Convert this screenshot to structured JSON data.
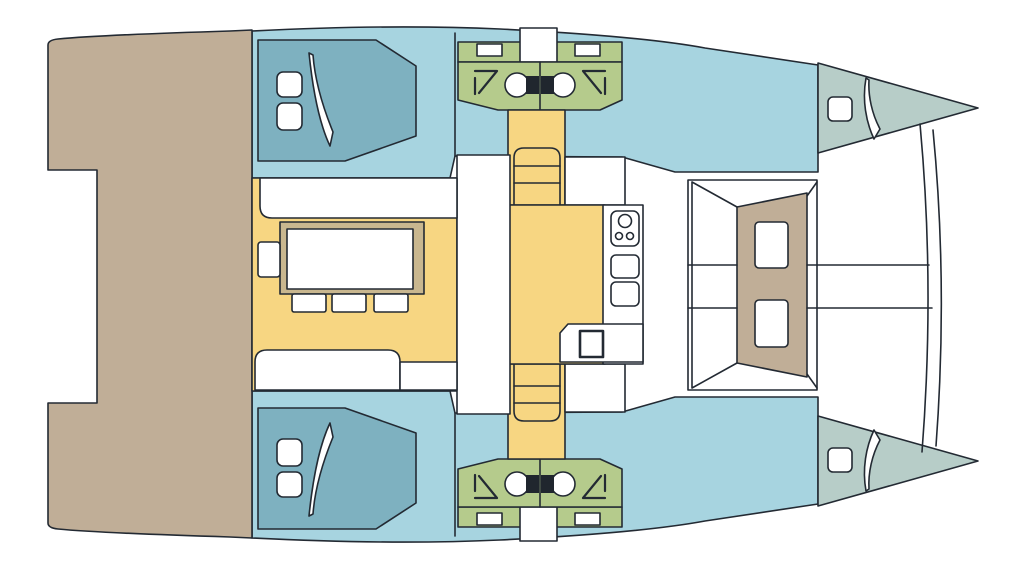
{
  "diagram": {
    "kind": "catamaran-deck-plan",
    "view": "top-down",
    "canvas": {
      "width": 1024,
      "height": 569
    }
  },
  "colors": {
    "background": "#ffffff",
    "outline": "#232a33",
    "hull": "#a7d4e0",
    "bed": "#7eb1c0",
    "bow_berth": "#b7cdc8",
    "bathroom": "#b5cb8c",
    "floor": "#f7d682",
    "deck": "#c0ae97",
    "furniture": "#ffffff",
    "table_rim": "#c9b78f",
    "toilet_tank": "#20262e"
  },
  "regions": {
    "aft_deck": "aft-deck-platform",
    "port_aft_cabin": "aft-cabin-with-double-bed",
    "port_head": "head-with-shower-and-toilet",
    "port_bow_berth": "bow-berth",
    "saloon": "saloon-dinette-with-table-and-stools",
    "galley": "galley-with-stove-and-sinks",
    "stairs": "companionway-steps-to-hull",
    "forward_cockpit": "forward-cockpit-lounge",
    "bridle": "bow-trampoline-bridle-lines"
  }
}
